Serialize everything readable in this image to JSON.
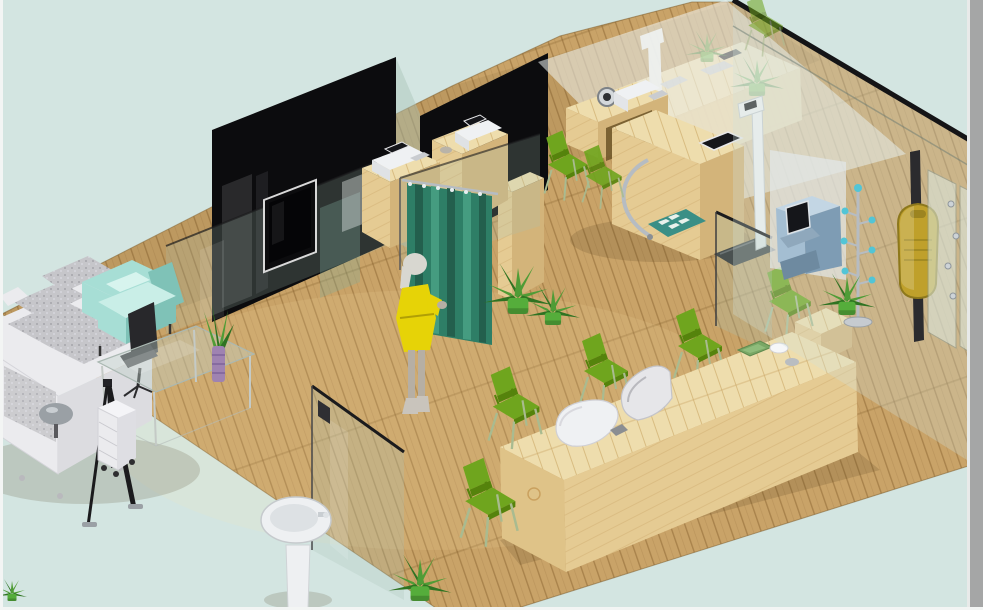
{
  "meta": {
    "title": "3D isometric interior rendering of a clinic / showroom interior",
    "canvas": {
      "width": 983,
      "height": 610
    },
    "style": "computer-generated isometric cutaway room on pale blue-green backdrop, light wood plank floor"
  },
  "palette": {
    "bg": "#d3e5e1",
    "borderLight": "#f3f5f4",
    "borderDark": "#a5a6a6",
    "floorBase": "#c9a368",
    "floorSeam": "#8a6430",
    "deskWoodTop": "#eeddad",
    "deskWoodSeam": "#cfae6e",
    "deskWoodFront": "#e5cb93",
    "deskWoodSide": "#d3b47a",
    "panelBlack": "#0c0c0e",
    "glassTint": "#a9c4b8",
    "glassEdge": "#1b1b1d",
    "fogWhite": "#eef4f2",
    "curtain": "#2e7e66",
    "curtainDark": "#235f4d",
    "curtainLight": "#459c80",
    "chairGreen": "#6fa51e",
    "chairGreenDark": "#55830c",
    "chairLeg": "#a9bb90",
    "sofaGray": "#c6c6ca",
    "sofaSpeckle": "#9b9ba1",
    "sofaWhite": "#ebebee",
    "armchairTeal": "#a7ded5",
    "armchairTealLight": "#c9eee7",
    "armchairTealDark": "#7fc2b7",
    "officeChairBlack": "#28282b",
    "lampGray": "#9aa0a5",
    "dressYellow": "#e6d307",
    "hairGray": "#d8d7d0",
    "skinGray": "#b6afa4",
    "leafGreen": "#4f9c36",
    "leafDark": "#2f7322",
    "potGreen": "#55ad3b",
    "vasePurple": "#9f83b1",
    "chrome": "#b6bcc2",
    "deviceWhite": "#eff1f3",
    "deviceGray": "#c9ccd0",
    "screenDark": "#15161a",
    "kioskBlue": "#a4bed2",
    "kioskBlueDark": "#7e9cb4",
    "kioskBlueLight": "#c3d6e4",
    "matTeal": "#3a8f86",
    "matSquare": "#e9f1ec",
    "boxYellow": "#bfa02b",
    "boxYellowDark": "#8d781c",
    "railDark": "#2b2b2e",
    "tealBall": "#52c5d6",
    "trayGreen": "#79a765",
    "basinWhite": "#eef0f2",
    "woodOpening": "#6b5327"
  },
  "scene": {
    "room": {
      "floor": "light wood planks laid diagonally",
      "background": "pale blue-green void outside the cutaway room",
      "walls": [
        "two black glass partition panels (back left)",
        "frameless tinted glass partitions",
        "full-height glass wall with doors on the right"
      ]
    },
    "inventory": [
      {
        "id": "lounge-sofa",
        "desc": "light gray L-shaped fabric sofa with speckled cushions"
      },
      {
        "id": "armchair",
        "desc": "mint-teal upholstered armchair with cushion"
      },
      {
        "id": "office-chair",
        "desc": "black swivel chair"
      },
      {
        "id": "coffee-table",
        "desc": "rectangular glass coffee table"
      },
      {
        "id": "table-plant",
        "desc": "grass plant in striped purple vase on the glass table"
      },
      {
        "id": "table-lamp",
        "desc": "gray dome lamp on sofa armrest"
      },
      {
        "id": "banner-stand",
        "desc": "black tripod display easel beside the sofa"
      },
      {
        "id": "drawer-cart",
        "desc": "white rolling drawer unit"
      },
      {
        "id": "wall-tv",
        "desc": "flat-screen TV mounted on the black partition"
      },
      {
        "id": "fitting-curtain",
        "desc": "green privacy curtain hanging from a glass panel"
      },
      {
        "id": "mannequin",
        "desc": "female figure in a yellow dress standing at the curtain"
      },
      {
        "id": "cabinet-a",
        "desc": "light wood cabinet with white printer/terminal on top"
      },
      {
        "id": "cabinet-b",
        "desc": "second wood cabinet with white device on top"
      },
      {
        "id": "tall-cabinet",
        "desc": "tall light wood cabinet in fitting area"
      },
      {
        "id": "exam-console",
        "desc": "curved wooden console with chrome arm and built-in tablet"
      },
      {
        "id": "vitals-devices",
        "desc": "white devices and gauge on the console"
      },
      {
        "id": "floor-mat",
        "desc": "teal floor mat with four white squares"
      },
      {
        "id": "stadiometer",
        "desc": "white height gauge with dark weighing platform"
      },
      {
        "id": "back-counter",
        "desc": "wooden service counter seen hazily through glass"
      },
      {
        "id": "reception-desk",
        "desc": "long light wood reception counter"
      },
      {
        "id": "desk-terminals",
        "desc": "two white rounded terminals on the reception desk"
      },
      {
        "id": "serving-tray",
        "desc": "green tray and white mouse at the counter end"
      },
      {
        "id": "side-chairs",
        "desc": "eight lime-green side chairs"
      },
      {
        "id": "kiosk",
        "desc": "blue self-service diagnostic kiosk with dark screen"
      },
      {
        "id": "coat-stand",
        "desc": "chrome coat stand with teal ball hooks"
      },
      {
        "id": "wall-box",
        "desc": "olive-yellow box mounted on a dark rail"
      },
      {
        "id": "glass-doors",
        "desc": "frameless glass doors with chrome fittings, right side"
      },
      {
        "id": "wash-basin",
        "desc": "white pedestal wash basin"
      },
      {
        "id": "potted-plants",
        "desc": "green leafy plants in pots around the room"
      }
    ],
    "chairs": [
      {
        "id": "chair-1",
        "transform": "translate(566,170) scale(0.9)"
      },
      {
        "id": "chair-2",
        "transform": "translate(602,181) scale(0.82)"
      },
      {
        "id": "chair-3",
        "transform": "translate(698,352) scale(1.0)"
      },
      {
        "id": "chair-4",
        "transform": "translate(604,377) scale(1.0)"
      },
      {
        "id": "chair-5",
        "transform": "translate(514,413) scale(1.06)"
      },
      {
        "id": "chair-6",
        "transform": "translate(488,508) scale(1.14)"
      },
      {
        "id": "chair-7",
        "transform": "translate(788,307) scale(0.95)"
      },
      {
        "id": "chair-8",
        "transform": "translate(764,30) scale(0.78)"
      }
    ],
    "plants": [
      {
        "id": "plant-1",
        "transform": "translate(518,314) scale(1.15)"
      },
      {
        "id": "plant-2",
        "transform": "translate(553,325) scale(0.9)"
      },
      {
        "id": "plant-3",
        "transform": "translate(420,601) scale(1.05)"
      },
      {
        "id": "plant-4",
        "transform": "translate(847,315) scale(0.95)"
      },
      {
        "id": "plant-5",
        "transform": "translate(757,96) scale(0.9)"
      },
      {
        "id": "plant-6",
        "transform": "translate(707,62) scale(0.72)"
      },
      {
        "id": "plant-7",
        "transform": "translate(12,601) scale(0.5)"
      }
    ]
  }
}
